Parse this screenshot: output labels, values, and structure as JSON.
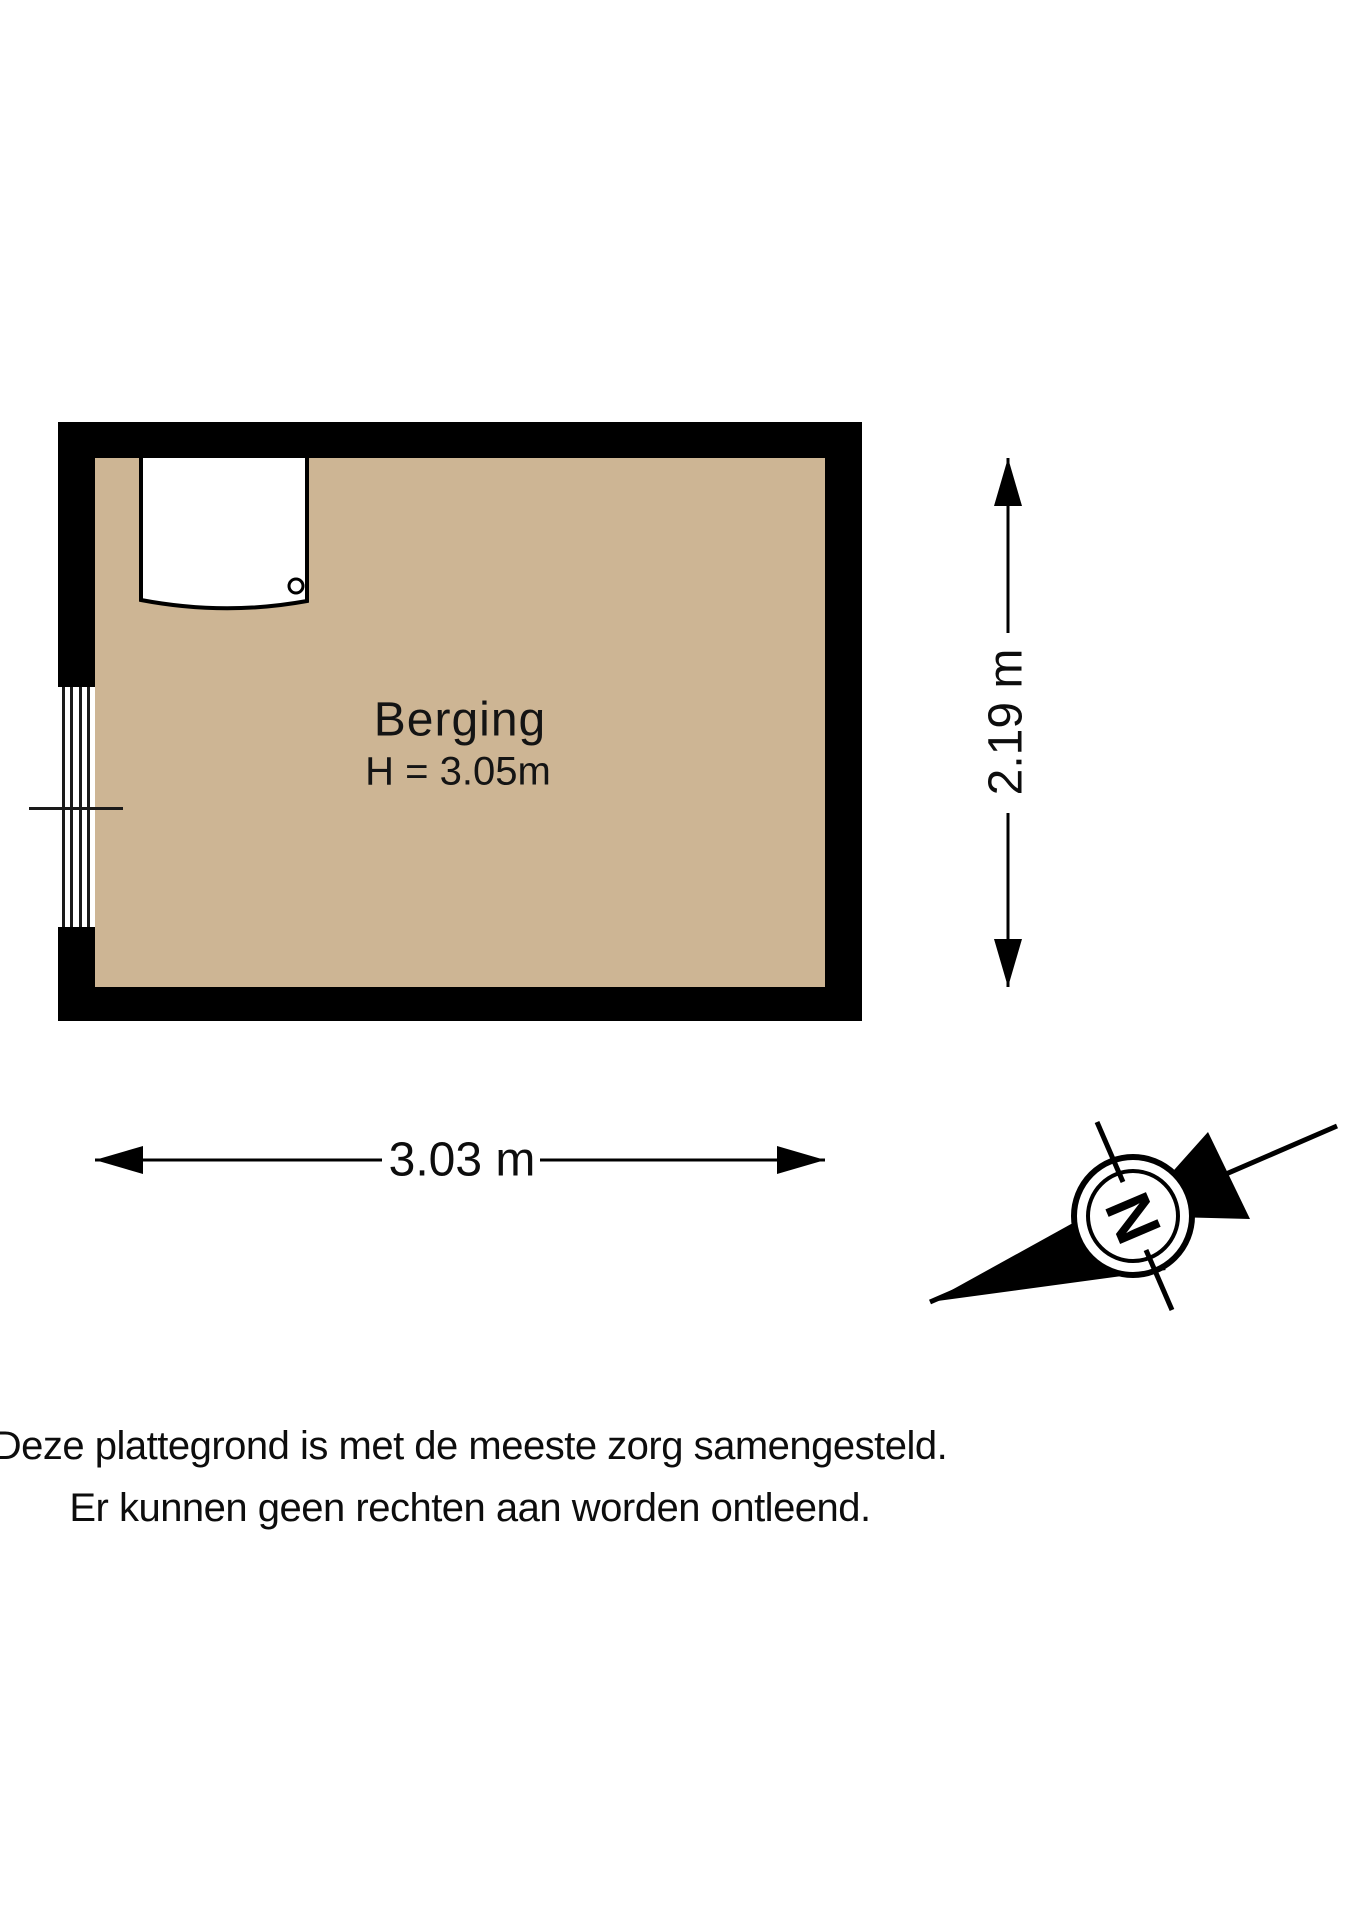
{
  "floorplan": {
    "room_label": "Berging",
    "ceiling_height_label": "H = 3.05m",
    "width_dimension": "3.03 m",
    "height_dimension": "2.19 m",
    "compass_letter": "N",
    "colors": {
      "floor_fill": "#CDB594",
      "wall": "#000000",
      "background": "#FFFFFF",
      "text": "#111111"
    }
  },
  "disclaimer": {
    "line1": "Deze plattegrond is met de meeste zorg samengesteld.",
    "line2": "Er kunnen geen rechten aan worden ontleend."
  }
}
